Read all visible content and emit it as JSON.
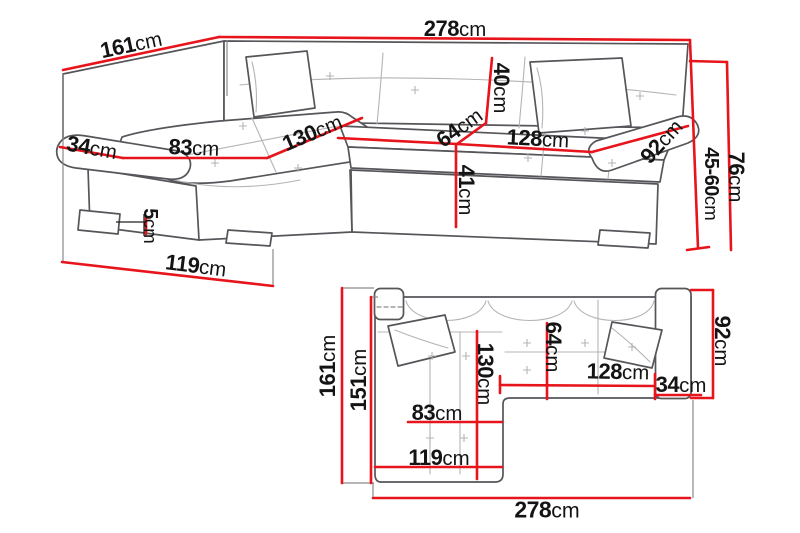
{
  "diagram": {
    "type": "corner-sofa-dimension-diagram",
    "views": {
      "perspective": {
        "name": "perspective-view",
        "dimensions": {
          "total_width": "278",
          "total_depth": "161",
          "armrest_width": "34",
          "chaise_seat_width": "83",
          "chaise_seat_length": "130",
          "seat_depth": "64",
          "backrest_cushion_height": "40",
          "seat_front_height": "41",
          "seat_width": "128",
          "armrest_length": "92",
          "armrest_height_range": "45-60",
          "total_height": "76",
          "leg_height": "5",
          "chaise_outer_length": "119"
        }
      },
      "plan": {
        "name": "top-down-plan-view",
        "dimensions": {
          "total_depth": "161",
          "body_depth": "151",
          "chaise_length": "130",
          "seat_depth": "64",
          "armrest_length": "92",
          "seat_width": "128",
          "armrest_width": "34",
          "chaise_seat_width": "83",
          "chaise_width": "119",
          "total_width": "278"
        }
      }
    },
    "units": {
      "cm": "cm"
    },
    "colors": {
      "dimension_line": "#e8141b",
      "outline": "#55555a",
      "seam": "#b4b4b6",
      "label_text": "#141414",
      "background": "#ffffff"
    }
  }
}
